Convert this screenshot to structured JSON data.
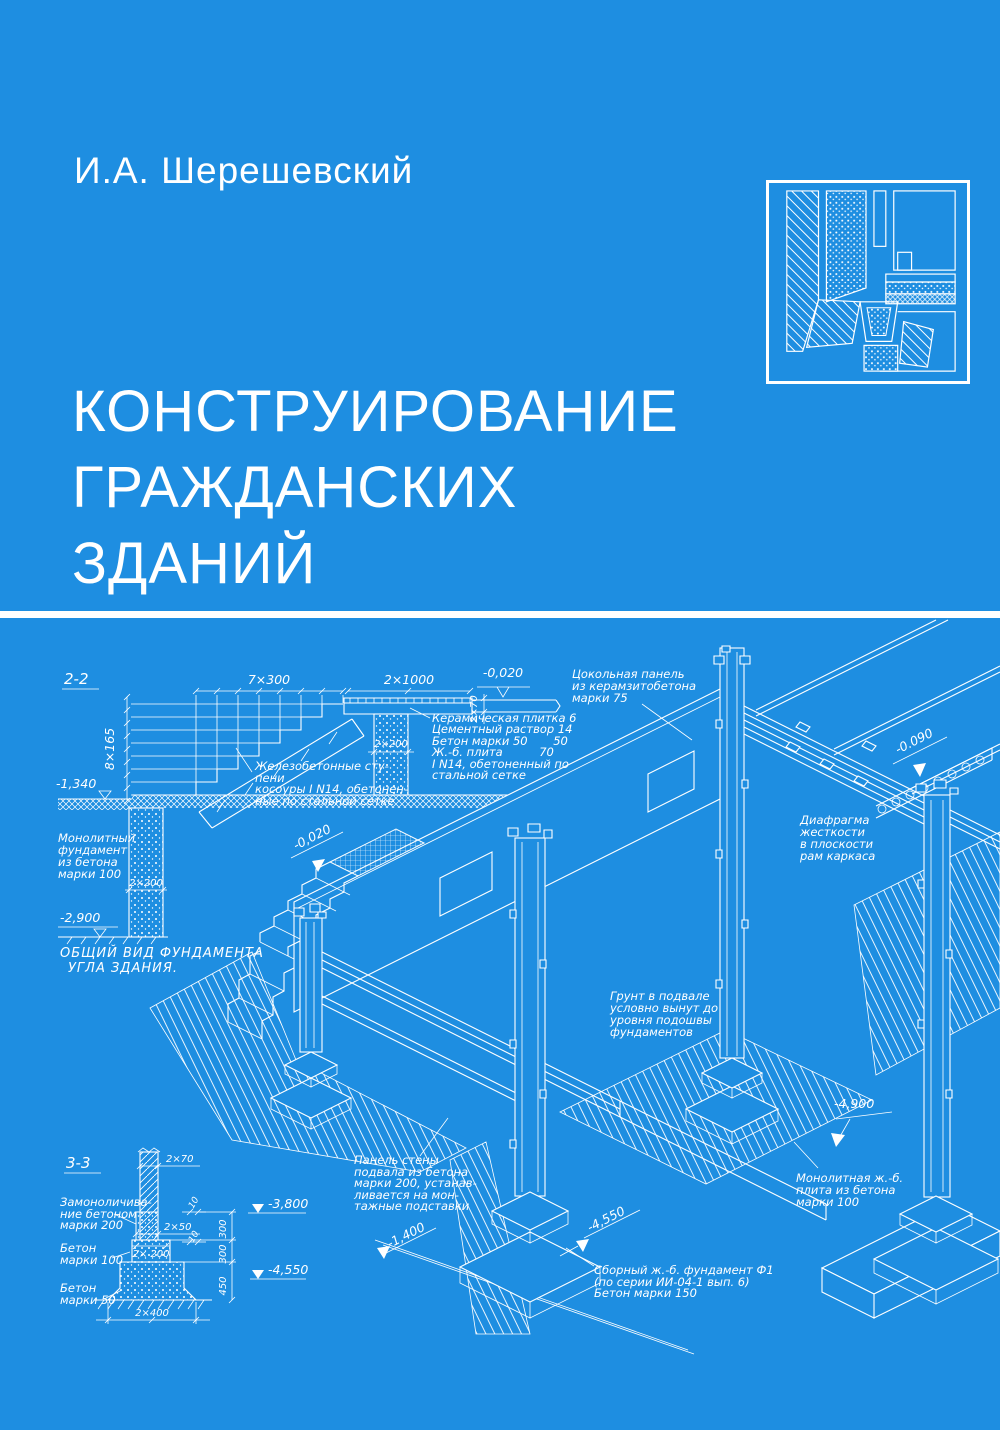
{
  "cover": {
    "author": "И.А. Шерешевский",
    "title": [
      "КОНСТРУИРОВАНИЕ",
      "ГРАЖДАНСКИХ",
      "ЗДАНИЙ"
    ],
    "colors": {
      "background": "#1e8ee1",
      "ink": "#ffffff"
    }
  },
  "drawing": {
    "sections": {
      "s22": "2-2",
      "s33": "3-3"
    },
    "dims": {
      "d7x300": "7×300",
      "d8x165": "8×165",
      "d2x1000": "2×1000",
      "d2x70a": "2×70",
      "d2x200a": "2×200",
      "d2x200b": "2×200",
      "d2x70b": "2×70",
      "d2x50": "2×50",
      "d2x200c": "2× 200",
      "d2x400": "2×400",
      "d300a": "300",
      "d300b": "300",
      "d450": "450",
      "d10a": "10",
      "d10b": "10",
      "d1400": "-1,400"
    },
    "levels": {
      "m0020a": "-0,020",
      "m0020b": "-0,020",
      "m0090": "-0.090",
      "m1340": "-1,340",
      "m2900": "-2,900",
      "m3800": "-3,800",
      "m4550a": "-4,550",
      "m4550b": "-4,550",
      "m4900": "-4,900"
    },
    "notes": {
      "steps": [
        "Железобетонные сту-",
        "пени",
        "косоуры I N14, обетонен-",
        "ные по стальной сетке"
      ],
      "floor": [
        "Керамическая плитка 6",
        "Цементный раствор 14",
        "Бетон марки 50       50",
        "Ж.-б. плита          70",
        "I N14, обетоненный по",
        "стальной сетке"
      ],
      "socle": [
        "Цокольная панель",
        "из керамзитобетона",
        "марки 75"
      ],
      "diaphragm": [
        "Диафрагма",
        "жесткости",
        "в плоскости",
        "рам каркаса"
      ],
      "mono_found": [
        "Монолитный",
        "фундамент",
        "из бетона",
        "марки 100"
      ],
      "general": [
        "ОБЩИЙ ВИД ФУНДАМЕНТА",
        "УГЛА ЗДАНИЯ."
      ],
      "soil": [
        "Грунт в подвале",
        "условно вынут до",
        "уровня подошвы",
        "фундаментов"
      ],
      "mono_slab": [
        "Монолитная ж.-б.",
        "плита из бетона",
        "марки 100"
      ],
      "grout": [
        "Замоноличива-",
        "ние бетоном",
        "марки 200"
      ],
      "b100": [
        "Бетон",
        "марки 100"
      ],
      "b50": [
        "Бетон",
        "марки 50"
      ],
      "wall_panel": [
        "Панель стены",
        "подвала из бетона",
        "марки 200, устанав-",
        "ливается на мон-",
        "тажные подставки"
      ],
      "precast": [
        "Сборный ж.-б. фундамент Ф1",
        "(по серии ИИ-04-1 вып. 6)",
        "Бетон марки 150"
      ]
    }
  }
}
